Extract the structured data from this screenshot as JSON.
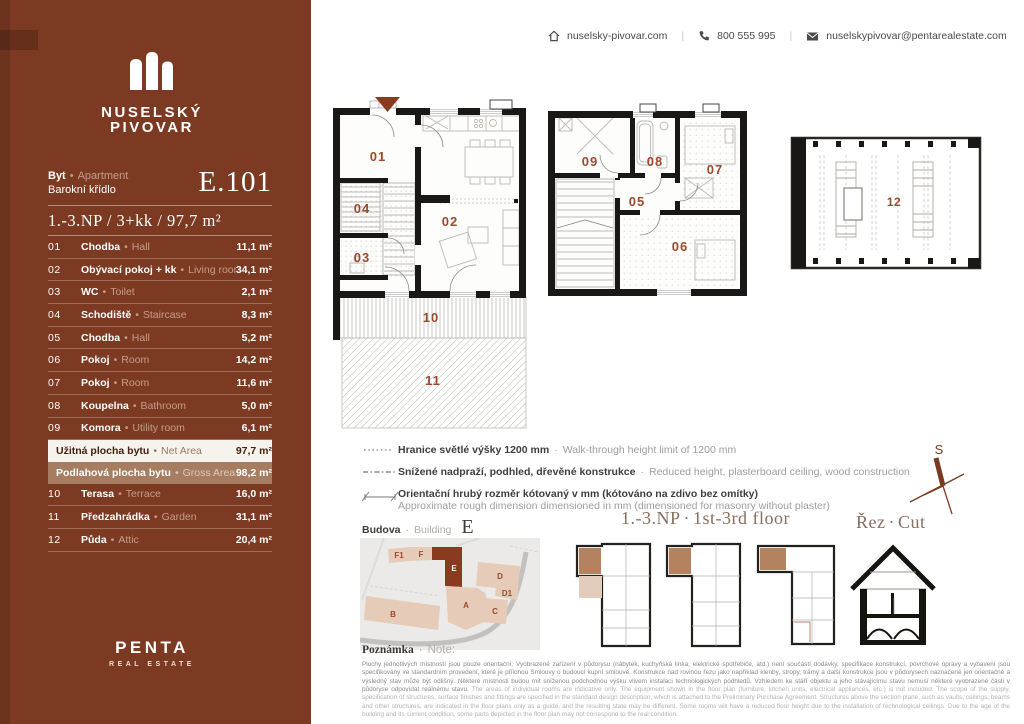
{
  "sep_bullet": "•",
  "sep_dot": "·",
  "header": {
    "website": "nuselsky-pivovar.com",
    "phone": "800 555 995",
    "email": "nuselskypivovar@pentarealestate.com"
  },
  "brand": {
    "name_line1": "NUSELSKÝ",
    "name_line2": "PIVOVAR"
  },
  "unit": {
    "type_cs": "Byt",
    "type_en": "Apartment",
    "wing": "Barokní křídlo",
    "code": "E.101",
    "summary": "1.-3.NP / 3+kk / 97,7 m²"
  },
  "rooms": [
    {
      "no": "01",
      "cs": "Chodba",
      "en": "Hall",
      "area": "11,1 m²"
    },
    {
      "no": "02",
      "cs": "Obývací pokoj + kk",
      "en": "Living room",
      "area": "34,1 m²"
    },
    {
      "no": "03",
      "cs": "WC",
      "en": "Toilet",
      "area": "2,1 m²"
    },
    {
      "no": "04",
      "cs": "Schodiště",
      "en": "Staircase",
      "area": "8,3 m²"
    },
    {
      "no": "05",
      "cs": "Chodba",
      "en": "Hall",
      "area": "5,2 m²"
    },
    {
      "no": "06",
      "cs": "Pokoj",
      "en": "Room",
      "area": "14,2 m²"
    },
    {
      "no": "07",
      "cs": "Pokoj",
      "en": "Room",
      "area": "11,6 m²"
    },
    {
      "no": "08",
      "cs": "Koupelna",
      "en": "Bathroom",
      "area": "5,0 m²"
    },
    {
      "no": "09",
      "cs": "Komora",
      "en": "Utility room",
      "area": "6,1 m²"
    }
  ],
  "totals": [
    {
      "cs": "Užitná plocha bytu",
      "en": "Net Area",
      "area": "97,7 m²"
    },
    {
      "cs": "Podlahová plocha bytu",
      "en": "Gross Area",
      "area": "98,2 m²"
    }
  ],
  "outdoor": [
    {
      "no": "10",
      "cs": "Terasa",
      "en": "Terrace",
      "area": "16,0 m²"
    },
    {
      "no": "11",
      "cs": "Předzahrádka",
      "en": "Garden",
      "area": "31,1 m²"
    },
    {
      "no": "12",
      "cs": "Půda",
      "en": "Attic",
      "area": "20,4 m²"
    }
  ],
  "developer": {
    "name": "PENTA",
    "sub": "REAL ESTATE"
  },
  "plans": {
    "labels": {
      "r01": "01",
      "r02": "02",
      "r03": "03",
      "r04": "04",
      "r05": "05",
      "r06": "06",
      "r07": "07",
      "r08": "08",
      "r09": "09",
      "r10": "10",
      "r11": "11",
      "r12": "12"
    }
  },
  "legend": [
    {
      "cs": "Hranice světlé výšky 1200 mm",
      "en": "Walk-through height limit of 1200 mm"
    },
    {
      "cs": "Snížené nadpraží, podhled, dřevěné konstrukce",
      "en": "Reduced height, plasterboard ceiling, wood construction"
    },
    {
      "cs": "Orientační hrubý rozměr kótovaný v mm (kótováno na zdivo bez omítky)",
      "en": "Approximate rough dimension dimensioned in mm (dimensioned for masonry without plaster)"
    }
  ],
  "minimap": {
    "building_cs": "Budova",
    "building_en": "Building",
    "building_code": "E",
    "floors_cs": "1.-3.NP",
    "floors_en": "1st-3rd floor",
    "section_cs": "Řez",
    "section_en": "Cut",
    "compass": "S",
    "site": [
      "F1",
      "F",
      "E",
      "D",
      "D1",
      "A",
      "B",
      "C"
    ]
  },
  "note": {
    "title_cs": "Poznámka",
    "title_en": "Note:",
    "cs": "Plochy jednotlivých místností jsou pouze orientační. Vyobrazené zařízení v půdorysu (nábytek, kuchyňská linka, elektrické spotřebiče, atd.) není součástí dodávky, specifikace konstrukcí, povrchové úpravy a vybavení jsou specifikovány ve standardním provedení, které je přílohou Smlouvy o budoucí kupní smlouvě. Konstrukce nad rovinou řezu jako například klenby, stropy, trámy a další konstrukce jsou v půdorysech naznačené jen orientačně a výsledný stav může být odlišný. Některé místnosti budou mít sníženou podchodnou výšku vlivem instalaci technologických podhledů. Vzhledem ke stáří objektu a jeho stávajícímu stavu nemusí některé vyobrazené části v půdoryse odpovídat reálnému stavu.",
    "en": "The areas of individual rooms are indicative only. The equipment shown in the floor plan (furniture, kitchen units, electrical appliances, etc.) is not included. The scope of the supply, specification of structures, surface finishes and fittings are specified in the standard design description, which is attached to the Preliminary Purchase Agreement. Structures above the section plane, such as vaults, ceilings, beams and other structures, are indicated in the floor plans only as a guide, and the resulting state may be different. Some rooms will have a reduced floor height due to the installation of technological ceilings. Due to the age of the building and its current condition, some parts depicted in the floor plan may not correspond to the real condition."
  },
  "theme": {
    "sidebar_bg": "#7C3A22",
    "accent": "#9B4A2C",
    "wall": "#1A1816",
    "net_row_bg": "#F6F2EC",
    "gross_row_bg": "#A67D61",
    "site_highlight": "#8A3A1F"
  }
}
